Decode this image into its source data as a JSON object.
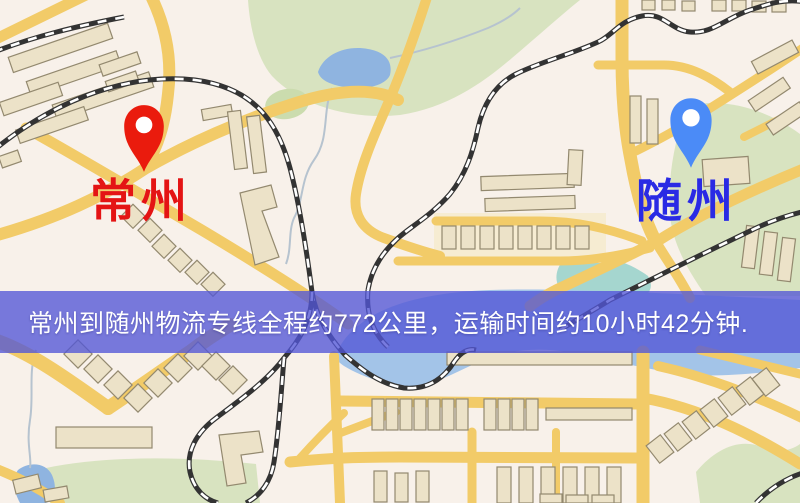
{
  "banner": {
    "text": "常州到随州物流专线全程约772公里，运输时间约10小时42分钟.",
    "route_origin": "常州",
    "route_destination": "随州",
    "distance_km": "772",
    "duration": "10小时42分钟"
  },
  "markers": {
    "origin": {
      "label": "常州",
      "pin": "red-map-pin"
    },
    "destination": {
      "label": "随州",
      "pin": "blue-map-pin"
    }
  },
  "palette": {
    "map_bg": "#f8f1ea",
    "park": "#d8e3c0",
    "water": "#8fb4e0",
    "road": "#f2cb68",
    "building": "#ece2c8",
    "building_stroke": "#93896f",
    "railway": "#333333",
    "banner_bg": "rgba(82,86,214,0.78)",
    "banner_text": "#ffffff",
    "origin_pin": "#ea1b0d",
    "origin_label": "#e41414",
    "destination_pin": "#4b8bf7",
    "destination_label": "#2a2ae4"
  }
}
